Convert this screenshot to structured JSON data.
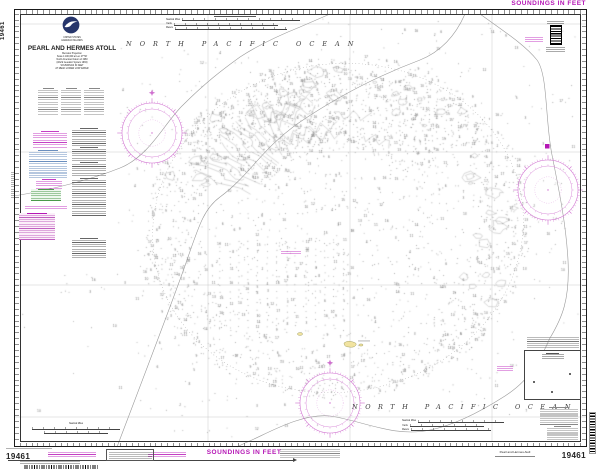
{
  "chart": {
    "number": "19461",
    "soundings_label": "SOUNDINGS IN FEET",
    "ocean_label": "NORTH PACIFIC OCEAN",
    "title_block": {
      "country": "UNITED STATES",
      "region": "HAWAIIAN ISLANDS",
      "title": "PEARL AND HERMES ATOLL",
      "projection": "Mercator Projection",
      "scale": "Scale 1:100,000 at Lat. 27°50'",
      "datum": "North American Datum of 1983",
      "datum2": "(World Geodetic System 1984)",
      "soundings1": "SOUNDINGS IN FEET",
      "soundings2": "AT MEAN LOWER LOW WATER"
    },
    "bottom_title": "Pearl and Hermes Atoll",
    "scale_bar_labels": {
      "nautical_miles": "Nautical Miles",
      "yards": "Yards",
      "meters": "Meters"
    }
  },
  "colors": {
    "magenta": "#b517b5",
    "rose_magenta": "#cf6fcf",
    "land_yellow": "#f1e3a0",
    "contour_gray": "#9a9a9a"
  }
}
